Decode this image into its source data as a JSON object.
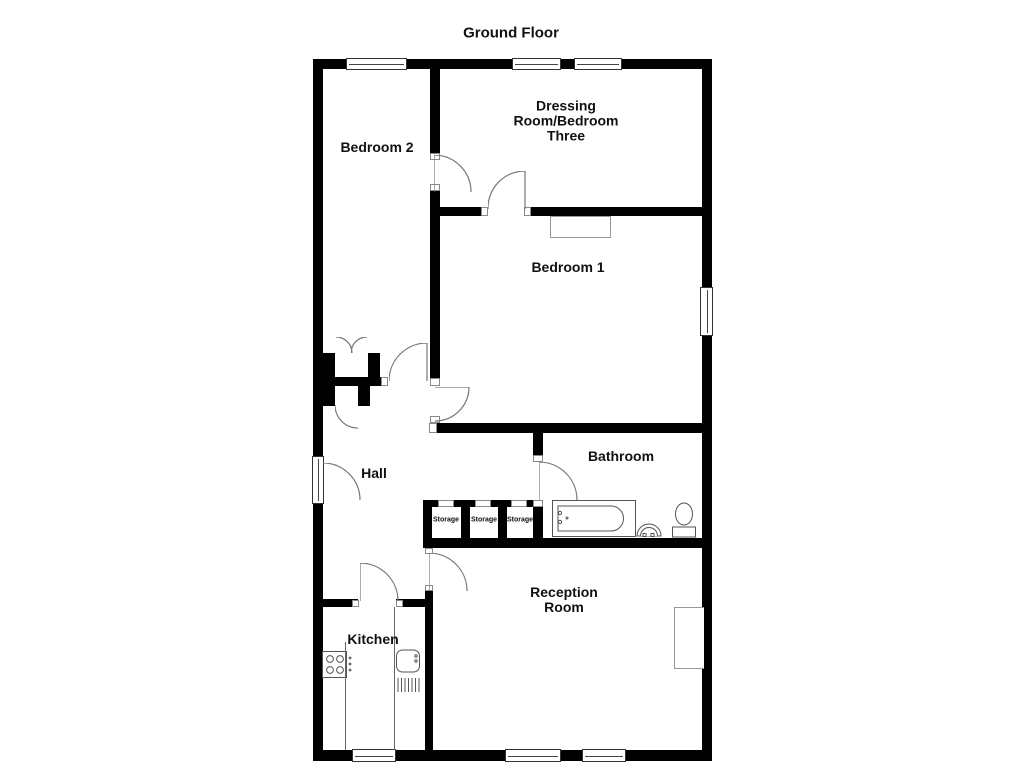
{
  "title": "Ground Floor",
  "rooms": {
    "bedroom2": "Bedroom 2",
    "dressing_room": "Dressing Room/Bedroom Three",
    "bedroom1": "Bedroom 1",
    "hall": "Hall",
    "bathroom": "Bathroom",
    "kitchen": "Kitchen",
    "reception": "Reception Room"
  },
  "storage_labels": [
    "Storage",
    "Storage",
    "Storage"
  ],
  "colors": {
    "wall": "#000000",
    "background": "#ffffff",
    "door_arc": "#777777",
    "fixture_outline": "#555555",
    "text": "#111111"
  },
  "symbols": [
    "window",
    "door-swing",
    "double-door-wardrobe",
    "bathtub",
    "pedestal-sink",
    "toilet",
    "stove-hob",
    "kitchen-sink-drainer",
    "wardrobe",
    "chimney-breast"
  ]
}
